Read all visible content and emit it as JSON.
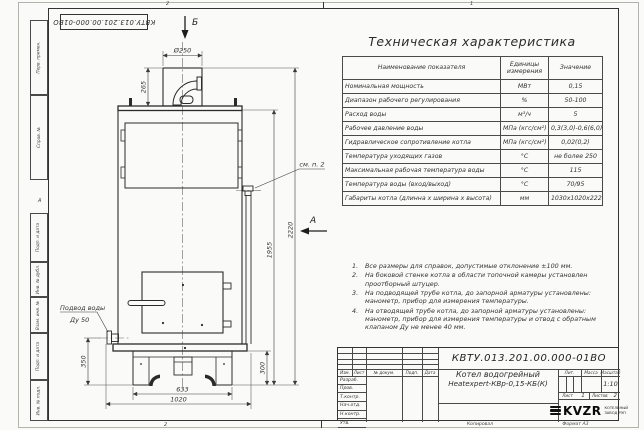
{
  "colors": {
    "line": "#2e2e2e",
    "paper": "#fafaf8",
    "ink": "#333333"
  },
  "frame": {
    "top_left_stamp": "КВТУ.013.201.00.000-01ВО",
    "zone_top_left": "2",
    "zone_top_right": "1",
    "zone_bottom_left": "2",
    "zone_left_letter": "А",
    "copied": "Копировал",
    "format": "Формат А3",
    "margin_boxes": [
      "Перв. примен.",
      "Справ. №",
      "Подп. и дата",
      "Инв. № дубл.",
      "Взам. инв. №",
      "Подп. и дата",
      "Инв. № подл."
    ]
  },
  "spec_table": {
    "title": "Техническая характеристика",
    "headers": [
      "Наименование показателя",
      "Единицы измерения",
      "Значение"
    ],
    "rows": [
      {
        "name": "Номинальная мощность",
        "unit": "МВт",
        "value": "0,15"
      },
      {
        "name": "Диапазон рабочего регулирования",
        "unit": "%",
        "value": "50-100"
      },
      {
        "name": "Расход воды",
        "unit": "м³/ч",
        "value": "5"
      },
      {
        "name": "Рабочее давление воды",
        "unit": "МПа (кгс/см²)",
        "value": "0,3(3,0)-0,6(6,0)"
      },
      {
        "name": "Гидравлическое сопротивление котла",
        "unit": "МПа (кгс/см²)",
        "value": "0,02(0,2)"
      },
      {
        "name": "Температура уходящих газов",
        "unit": "°С",
        "value": "не более 250"
      },
      {
        "name": "Максимальная рабочая температура воды",
        "unit": "°С",
        "value": "115"
      },
      {
        "name": "Температура воды (вход/выход)",
        "unit": "°С",
        "value": "70/95"
      },
      {
        "name": "Габариты котла (длинна х ширина х высота)",
        "unit": "мм",
        "value": "1030х1020х2220"
      }
    ]
  },
  "notes": [
    {
      "num": "1.",
      "text": "Все размеры для справок, допустимые отклонение ±100 мм."
    },
    {
      "num": "2.",
      "text": "На боковой стенке котла в области топочной камеры установлен проотборный штуцер."
    },
    {
      "num": "3.",
      "text": "На подводящей трубе котла, до запорной арматуры установлены: манометр, прибор для измерения температуры."
    },
    {
      "num": "4.",
      "text": "На отводящей трубе котла, до запорной арматуры установлены: манометр, прибор для измерения температуры и отвод с обратным клапаном Ду не менее 40 мм."
    }
  ],
  "drawing": {
    "dims": {
      "chimney_dia": "Ø250",
      "chimney_h": "265",
      "total_h": "2220",
      "body_h": "1955",
      "left_h": "350",
      "base_h": "300",
      "base_w": "633",
      "total_w": "1020"
    },
    "labels": {
      "view_a": "А",
      "view_b": "Б",
      "see_note": "см. п. 2",
      "water1": "Подвод воды",
      "water2": "Ду 50"
    }
  },
  "title_block": {
    "doc_number": "КВТУ.013.201.00.000-01ВО",
    "name_line1": "Котел водогрейный",
    "name_line2": "Heatexpert-КВр-0,15-КБ(К)",
    "col_izm": "Изм.",
    "col_list": "Лист",
    "col_doc": "№ докум.",
    "col_podp": "Подп.",
    "col_data": "Дата",
    "roles": [
      "Разраб.",
      "Пров.",
      "Т.контр.",
      "Нач.отд.",
      "Н.контр.",
      "Утв."
    ],
    "lit": "Лит.",
    "mass": "Масса",
    "scale": "Масштаб",
    "scale_value": "1:10",
    "sheet": "Лист",
    "sheet_value": "1",
    "sheets": "Листов",
    "sheets_value": "2",
    "brand": "KVZR",
    "brand_line1": "КОТЕЛЬНЫЙ",
    "brand_line2": "ЗАВОД РЭП"
  }
}
